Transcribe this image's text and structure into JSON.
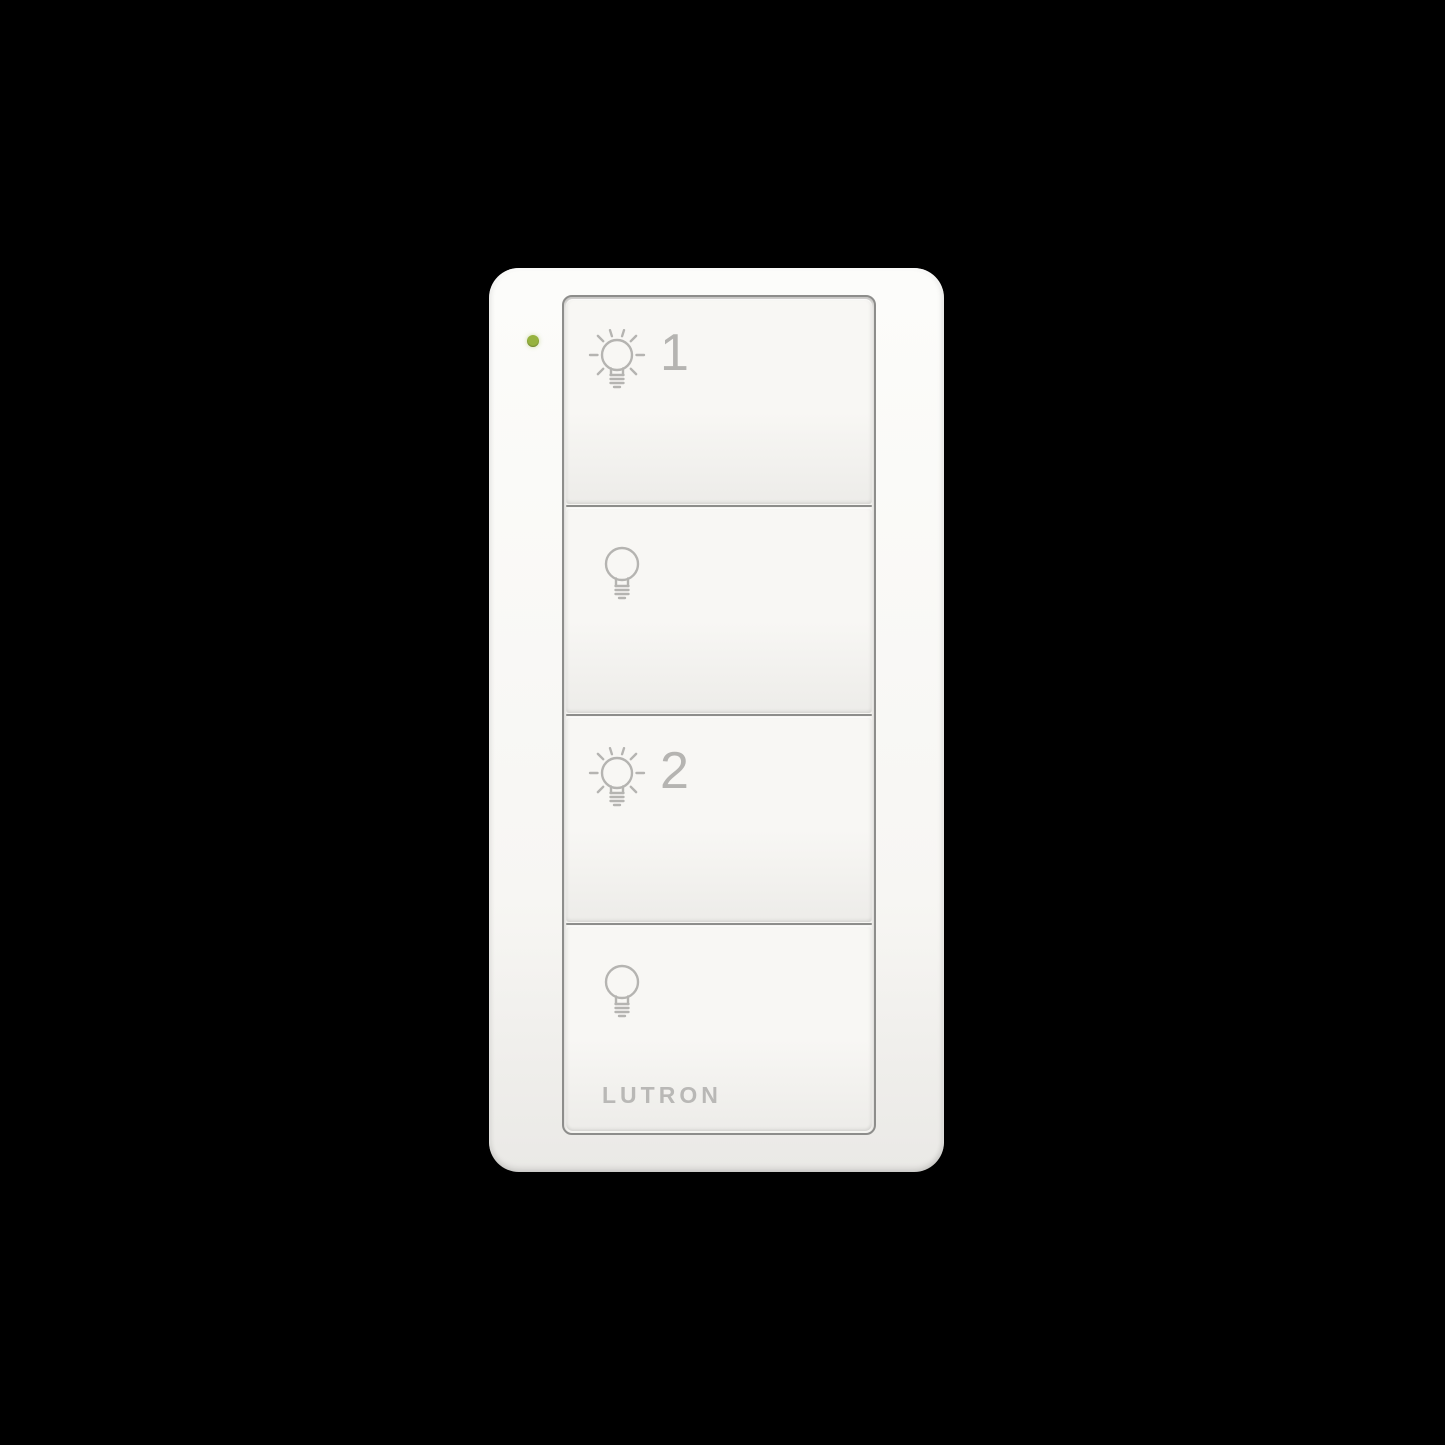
{
  "device": {
    "brand_label": "LUTRON",
    "status_led": {
      "state": "on",
      "color": "#96b23f"
    },
    "buttons": [
      {
        "name": "light-1-on",
        "icon": "bulb-on-icon",
        "label": "1"
      },
      {
        "name": "light-1-off",
        "icon": "bulb-off-icon",
        "label": ""
      },
      {
        "name": "light-2-on",
        "icon": "bulb-on-icon",
        "label": "2"
      },
      {
        "name": "light-2-off",
        "icon": "bulb-off-icon",
        "label": ""
      }
    ],
    "colors": {
      "background": "#000000",
      "body_top": "#fcfcfa",
      "body_mid": "#f7f6f3",
      "body_bottom": "#eae9e6",
      "button_top": "#f8f7f4",
      "button_bottom": "#edece9",
      "seam": "#8d8d8b",
      "icon": "#b5b4b1",
      "logo": "#b9b8b6",
      "led": "#96b23f"
    }
  }
}
